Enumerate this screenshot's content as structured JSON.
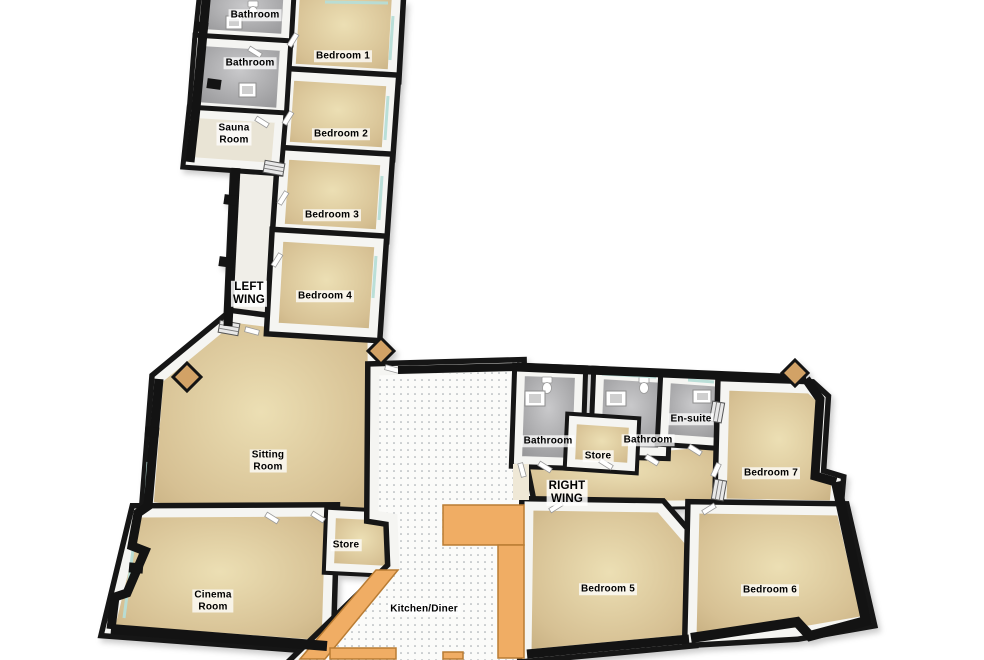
{
  "title": "3D Floor Plan",
  "colors": {
    "floor_tan": "#d6c093",
    "floor_bathroom": "#a5a5a7",
    "floor_tile": "#fbfbf9",
    "floor_corridor": "#f0eee8",
    "counter_orange": "#f0ad64",
    "wall_top": "#161616",
    "wall_face": "#f5f5f2",
    "window_glass": "#b7ded7",
    "porch": "#d2a266",
    "label_background": "rgba(255,255,255,0.75)"
  },
  "rooms": [
    {
      "id": "bathroom-top",
      "label": "Bathroom"
    },
    {
      "id": "bathroom-2",
      "label": "Bathroom"
    },
    {
      "id": "sauna-room",
      "label": "Sauna\nRoom"
    },
    {
      "id": "bedroom-1",
      "label": "Bedroom 1"
    },
    {
      "id": "bedroom-2",
      "label": "Bedroom 2"
    },
    {
      "id": "bedroom-3",
      "label": "Bedroom 3"
    },
    {
      "id": "bedroom-4",
      "label": "Bedroom 4"
    },
    {
      "id": "left-wing",
      "label": "LEFT\nWING"
    },
    {
      "id": "sitting-room",
      "label": "Sitting\nRoom"
    },
    {
      "id": "store-left",
      "label": "Store"
    },
    {
      "id": "cinema-room",
      "label": "Cinema\nRoom"
    },
    {
      "id": "kitchen-diner",
      "label": "Kitchen/Diner"
    },
    {
      "id": "bathroom-r1",
      "label": "Bathroom"
    },
    {
      "id": "store-right",
      "label": "Store"
    },
    {
      "id": "bathroom-r2",
      "label": "Bathroom"
    },
    {
      "id": "en-suite",
      "label": "En-suite"
    },
    {
      "id": "right-wing",
      "label": "RIGHT\nWING"
    },
    {
      "id": "bedroom-7",
      "label": "Bedroom 7"
    },
    {
      "id": "bedroom-5",
      "label": "Bedroom 5"
    },
    {
      "id": "bedroom-6",
      "label": "Bedroom 6"
    }
  ]
}
